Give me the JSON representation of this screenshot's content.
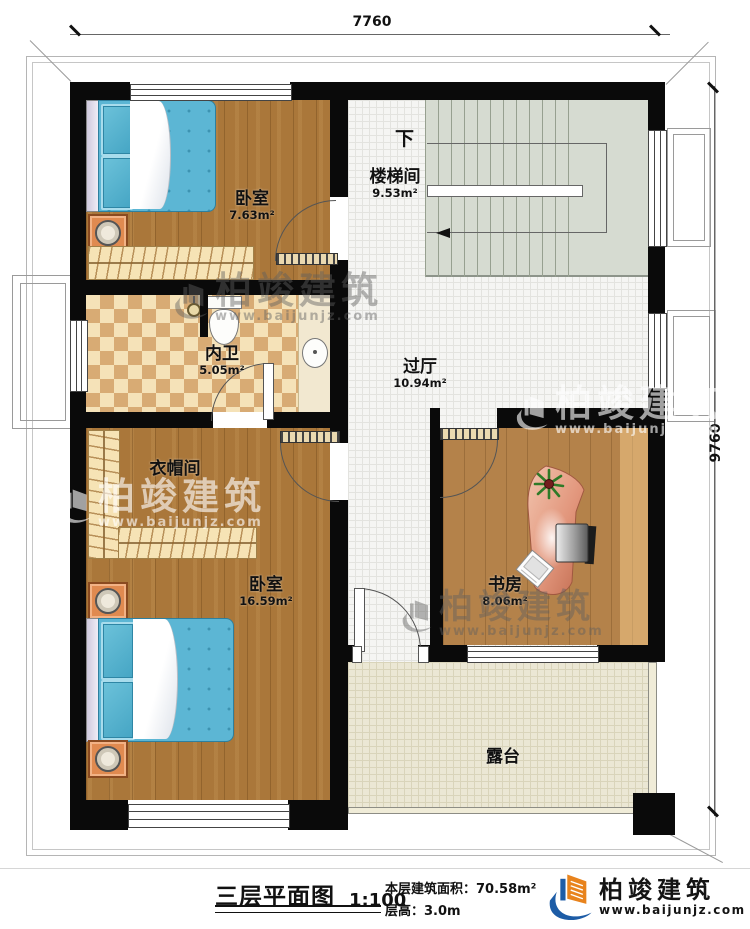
{
  "plan": {
    "dimensions": {
      "top": "7760",
      "right": "9760"
    },
    "rooms": [
      {
        "name": "卧室",
        "area": "7.63m²"
      },
      {
        "name": "楼梯间",
        "area": "9.53m²"
      },
      {
        "name": "内卫",
        "area": "5.05m²"
      },
      {
        "name": "过厅",
        "area": "10.94m²"
      },
      {
        "name": "衣帽间",
        "area": ""
      },
      {
        "name": "卧室",
        "area": "16.59m²"
      },
      {
        "name": "书房",
        "area": "8.06m²"
      },
      {
        "name": "露台",
        "area": ""
      }
    ],
    "stairs": {
      "down_label": "下"
    }
  },
  "footer": {
    "title": "三层平面图",
    "scale": "1:100",
    "building_area": "本层建筑面积：70.58m²",
    "floor_height": "层高：3.0m"
  },
  "brand": {
    "name": "柏竣建筑",
    "url": "www.baijunjz.com"
  },
  "colors": {
    "wall": "#0a0a0a",
    "brand_orange": "#e8831d",
    "brand_blue": "#1d5ca6"
  }
}
